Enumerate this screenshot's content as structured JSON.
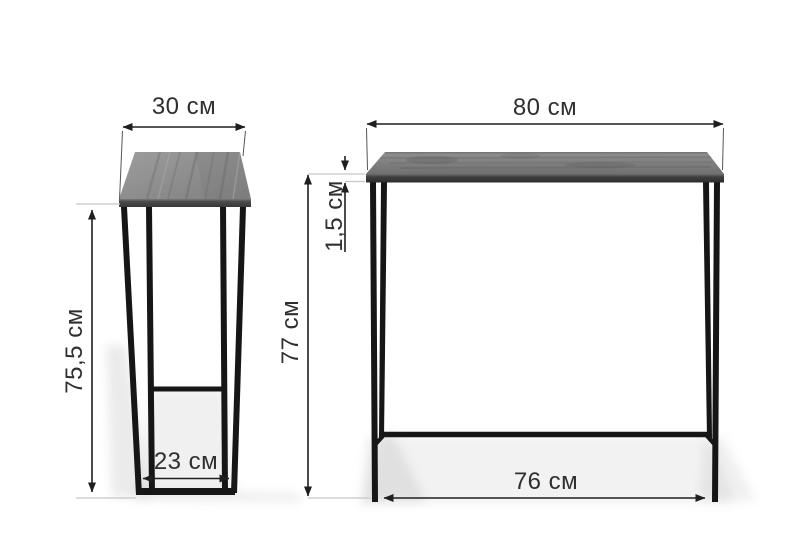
{
  "figure": {
    "kind": "furniture-dimension-diagram",
    "unit": "см"
  },
  "side_view": {
    "width_label": "30 см",
    "height_label": "75,5 см",
    "base_depth_label": "23 см"
  },
  "front_view": {
    "width_label": "80 см",
    "top_thickness_label": "1,5 см",
    "height_label": "77 см",
    "base_width_label": "76 см"
  },
  "colors": {
    "background": "#ffffff",
    "dimension_line": "#1f1f1f",
    "dimension_text": "#2f2f2f",
    "extension_line_dark": "#555555",
    "extension_line_light": "#c6c6c6",
    "metal_frame": "#161616",
    "tabletop_wood_light": "#9b9b9b",
    "tabletop_wood_dark": "#747474",
    "tabletop_edge_dark": "#383838"
  }
}
